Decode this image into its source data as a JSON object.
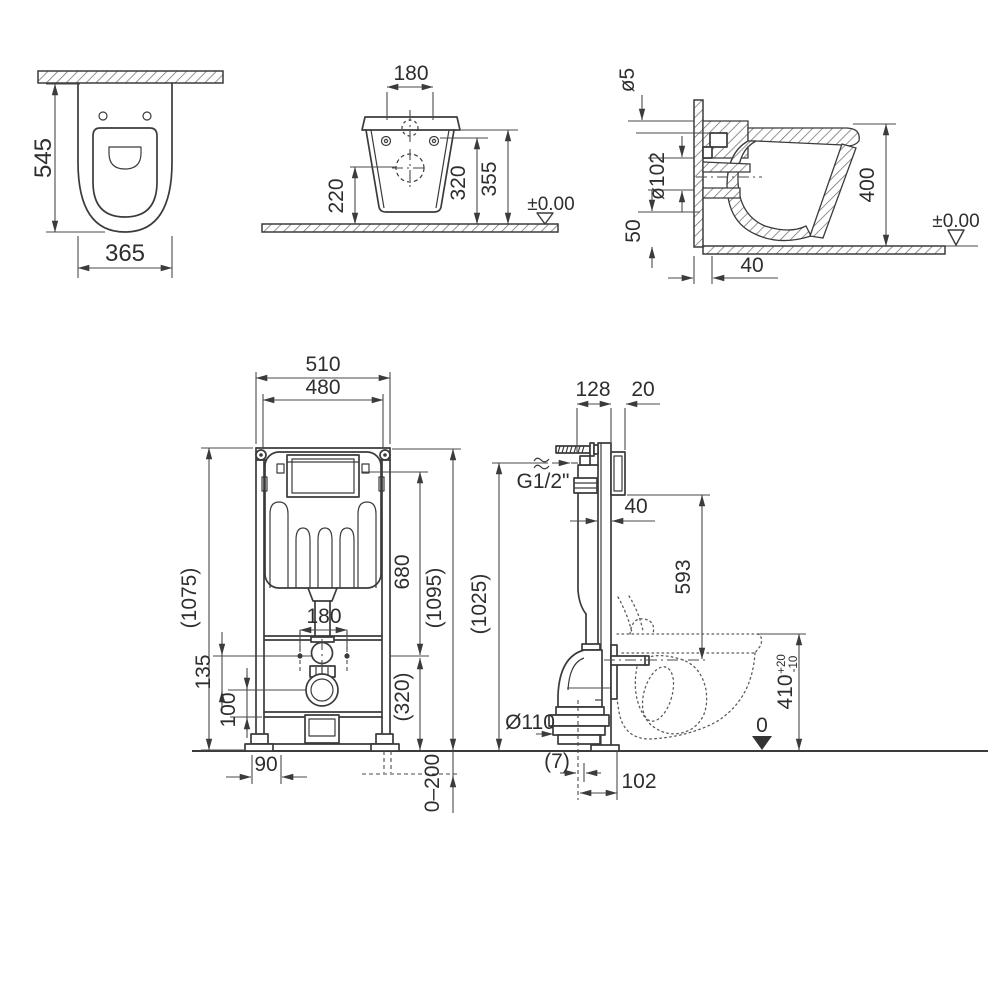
{
  "style": {
    "line_color": "#3b3b3b",
    "text_color": "#2e2e2e",
    "background": "#ffffff"
  },
  "pan_top_view": {
    "depth": "545",
    "width": "365"
  },
  "pan_front_view": {
    "hole_spacing": "180",
    "h_underside": "220",
    "h_holes": "320",
    "h_top": "355",
    "datum": "±0.00"
  },
  "pan_side_view": {
    "seat_hole_dia": "ø5",
    "outlet_dia": "ø102",
    "height": "400",
    "h_bottom": "50",
    "offset": "40",
    "datum": "±0.00"
  },
  "frame_front_view": {
    "width_outer": "510",
    "width_inner": "480",
    "height_left": "(1075)",
    "height_flush": "680",
    "height_right": "(1095)",
    "stud_spacing": "180",
    "h_135": "135",
    "h_100": "100",
    "stud_height": "(320)",
    "foot_width": "90",
    "foot_range": "0–200"
  },
  "frame_side_view": {
    "depth": "128",
    "plate": "20",
    "supply_thread": "G1/2\"",
    "profile": "40",
    "h_593": "593",
    "height": "(1025)",
    "drain_dia": "Ø110",
    "bowl_height": "410",
    "tol_plus": "+20",
    "tol_minus": "-10",
    "datum_zero": "0",
    "offset": "(7)",
    "drain_offset": "102"
  }
}
